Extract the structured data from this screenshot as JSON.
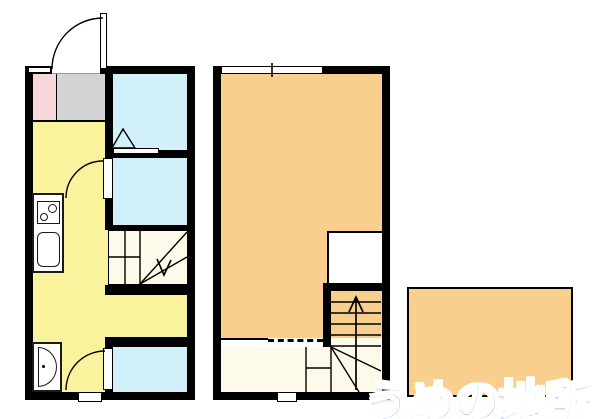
{
  "colors": {
    "wall": "#000000",
    "dk-yellow": "#f8f39c",
    "wet-blue": "#d2f0fa",
    "genkan-pink": "#f7d7da",
    "genkan-gray": "#d4d4d6",
    "room-orange": "#f9cf8e",
    "stair-cream": "#fdfae9",
    "watermark-blue": "#a9c2e4"
  },
  "rooms": {
    "genkan": {
      "label": "玄関"
    },
    "bath": {
      "label": "浴室"
    },
    "dressing": {
      "line1": "脱衣",
      "line2": "室"
    },
    "dk": {
      "name": "DK",
      "size": "5帖"
    },
    "wc": {
      "label": "WC"
    },
    "western": {
      "name": "洋室",
      "size": "7.2帖"
    },
    "loft": {
      "name": "ロフト",
      "size": "3帖"
    }
  },
  "watermark": {
    "text": "うめの地所"
  }
}
